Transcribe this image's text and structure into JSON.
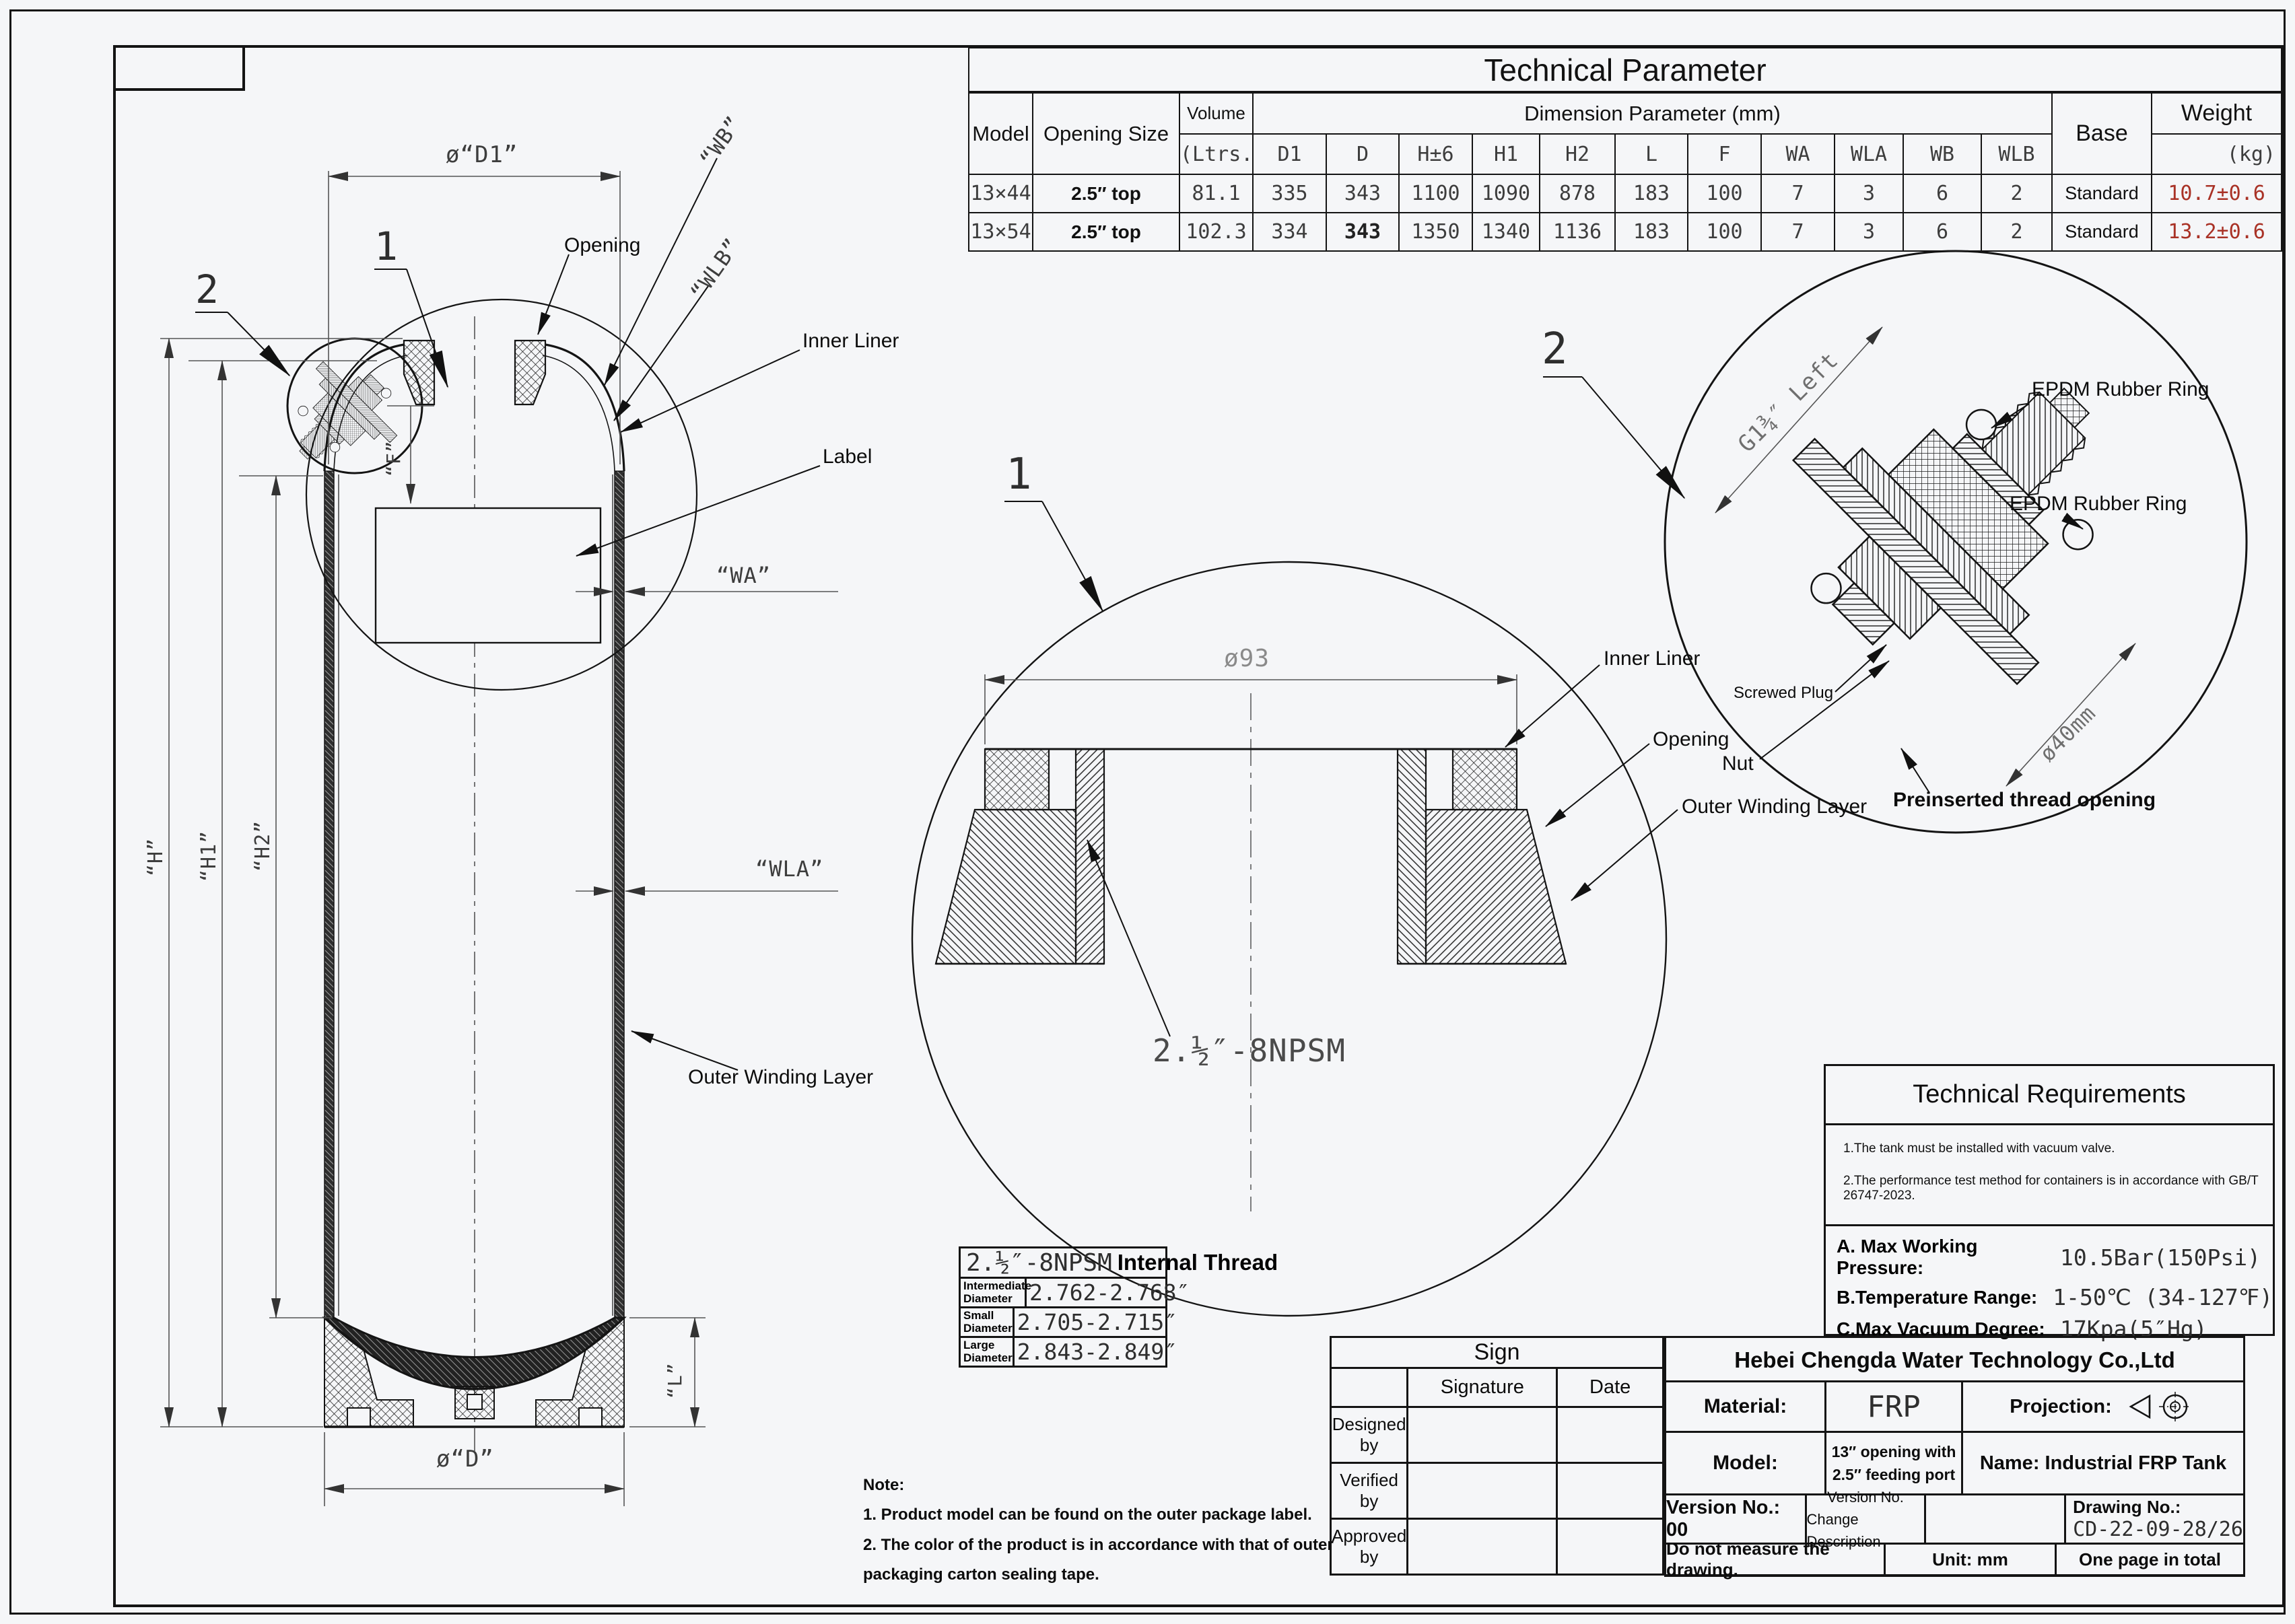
{
  "colors": {
    "line": "#141414",
    "dim": "#555555",
    "cad_text": "#3d3d3d",
    "red": "#a93226",
    "background": "#f5f6f8"
  },
  "param_table": {
    "title": "Technical Parameter",
    "col_model": "Model",
    "col_opening": "Opening Size",
    "col_volume": "Volume",
    "col_volume_unit": "(Ltrs.)",
    "col_dims": "Dimension Parameter (mm)",
    "dim_cols": [
      "D1",
      "D",
      "H±6",
      "H1",
      "H2",
      "L",
      "F",
      "WA",
      "WLA",
      "WB",
      "WLB"
    ],
    "col_base": "Base",
    "col_weight": "Weight",
    "col_weight_unit": "(kg)",
    "rows": [
      {
        "model": "13×44",
        "opening": "2.5″ top",
        "volume": "81.1",
        "dims": [
          "335",
          "343",
          "1100",
          "1090",
          "878",
          "183",
          "100",
          "7",
          "3",
          "6",
          "2"
        ],
        "base": "Standard",
        "weight": "10.7±0.6"
      },
      {
        "model": "13×54",
        "opening": "2.5″ top",
        "volume": "102.3",
        "dims": [
          "334",
          "343",
          "1350",
          "1340",
          "1136",
          "183",
          "100",
          "7",
          "3",
          "6",
          "2"
        ],
        "base": "Standard",
        "weight": "13.2±0.6"
      }
    ]
  },
  "main_view": {
    "dim_d1": "ø“D1”",
    "dim_wb": "“WB”",
    "dim_wlb": "“WLB”",
    "dim_wa": "“WA”",
    "dim_wla": "“WLA”",
    "dim_h": "“H”",
    "dim_h1": "“H1”",
    "dim_h2": "“H2”",
    "dim_f": "“F”",
    "dim_l": "“L”",
    "dim_d": "ø“D”",
    "label_opening": "Opening",
    "label_inner_liner": "Inner Liner",
    "label_label": "Label",
    "label_outer_winding": "Outer Winding Layer",
    "callout_1": "1",
    "callout_2": "2"
  },
  "detail_1": {
    "callout": "1",
    "dim_diameter": "ø93",
    "thread": "2.½″-8NPSM",
    "label_inner_liner": "Inner Liner",
    "label_opening": "Opening",
    "label_outer_winding": "Outer Winding Layer"
  },
  "detail_2": {
    "callout": "2",
    "dim_thread": "G1¾″ Left",
    "dim_diameter": "ø40mm",
    "label_epdm_1": "EPDM Rubber Ring",
    "label_epdm_2": "EPDM Rubber Ring",
    "label_screwed_plug": "Screwed Plug",
    "label_nut": "Nut",
    "label_preinserted": "Preinserted thread opening"
  },
  "thread_table": {
    "title_thread": "2.½″-8NPSM",
    "title_rest": "Internal Thread",
    "rows": [
      {
        "label": "Intermediate Diameter",
        "value": "2.762-2.768″"
      },
      {
        "label": "Small Diameter",
        "value": "2.705-2.715″"
      },
      {
        "label": "Large Diameter",
        "value": "2.843-2.849″"
      }
    ]
  },
  "tech_req": {
    "title": "Technical Requirements",
    "notes": [
      "1.The tank must be installed with vacuum valve.",
      "2.The performance test method for containers is in accordance with GB/T 26747-2023."
    ],
    "specs": [
      {
        "label": "A. Max Working Pressure:",
        "value": "10.5Bar(150Psi)"
      },
      {
        "label": "B.Temperature Range:",
        "value": "1-50℃ (34-127℉)"
      },
      {
        "label": "C.Max Vacuum Degree:",
        "value": "17Kpa(5″Hg)"
      }
    ]
  },
  "notes": {
    "title": "Note:",
    "items": [
      "1. Product model can be found on the outer package label.",
      "2. The color of the product is in accordance with that of outer packaging carton sealing tape."
    ]
  },
  "sign_block": {
    "title": "Sign",
    "col_signature": "Signature",
    "col_date": "Date",
    "rows": [
      "Designed by",
      "Verified by",
      "Approved by"
    ]
  },
  "title_block": {
    "company": "Hebei Chengda Water Technology Co.,Ltd",
    "material_label": "Material:",
    "material_value": "FRP",
    "projection_label": "Projection:",
    "model_label": "Model:",
    "model_value_1": "13″ opening with",
    "model_value_2": "2.5″ feeding port",
    "name": "Name: Industrial FRP Tank",
    "version": "Version No.: 00",
    "version_col_1": "Version No.",
    "version_col_2": "Change Description",
    "drawing_no_label": "Drawing No.:",
    "drawing_no": "CD-22-09-28/26",
    "note_measure": "Do not measure the drawing.",
    "unit": "Unit: mm",
    "pages": "One page in total"
  }
}
